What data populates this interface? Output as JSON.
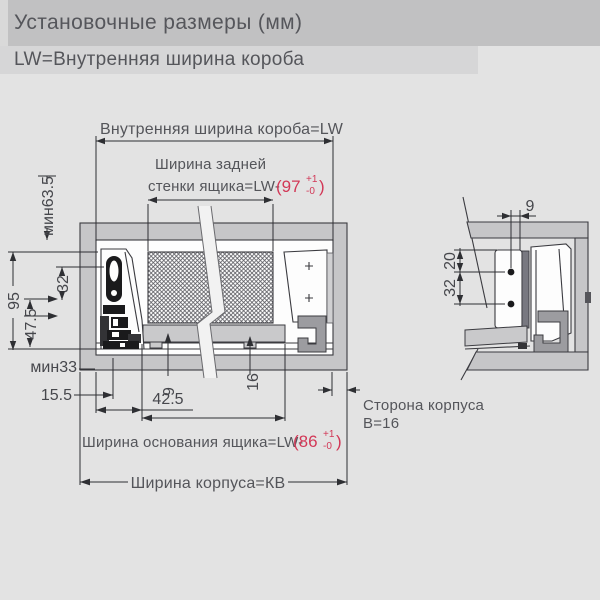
{
  "header": {
    "title": "Установочные размеры (мм)",
    "subtitle": "LW=Внутренняя ширина короба"
  },
  "colors": {
    "accent_red": "#d23857",
    "cabinet_gray": "#c6c6c8",
    "background": "#e3e3e3"
  },
  "front_view": {
    "top_label": "Внутренняя ширина короба=LW",
    "back_wall_line1": "Ширина задней",
    "back_wall_line2": "стенки ящика=LW-",
    "back_tol_pre": "(97",
    "back_tol_sup": "+1",
    "back_tol_sub": "-0",
    "back_tol_close": ")",
    "base_label": "Ширина основания ящика=LW-",
    "base_tol_pre": "(86",
    "base_tol_sup": "+1",
    "base_tol_sub": "-0",
    "base_tol_close": ")",
    "kb_label": "Ширина корпуса=КВ",
    "dim_min_top": "мин63.5",
    "dim_95": "95",
    "dim_32": "32",
    "dim_47_5": "47.5",
    "dim_min_bottom": "мин33",
    "dim_15_5": "15.5",
    "dim_42_5": "42.5",
    "dim_9": "9",
    "dim_16": "16"
  },
  "side_view": {
    "dim_9": "9",
    "dim_20": "20",
    "dim_32": "32",
    "label_line1": "Сторона корпуса",
    "label_line2": "В=16"
  }
}
